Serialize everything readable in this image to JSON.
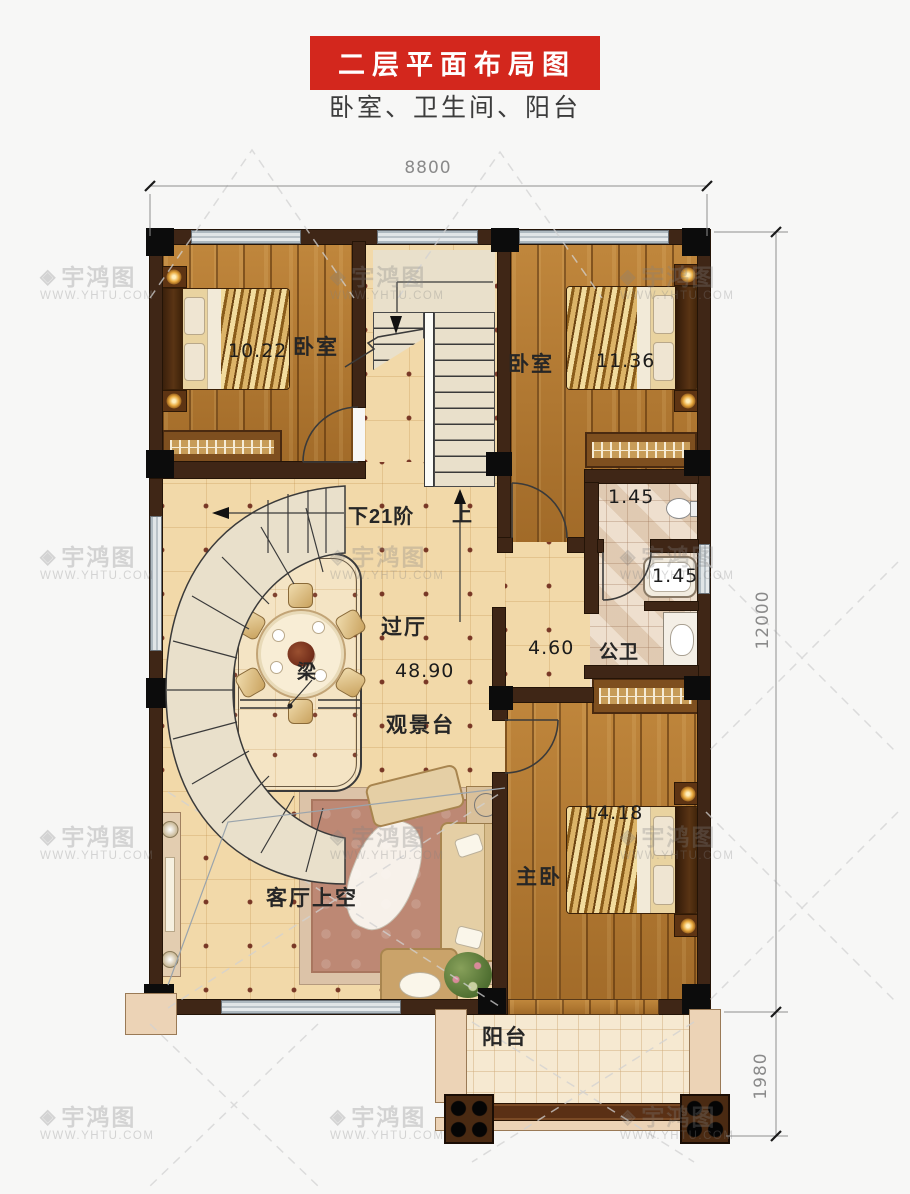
{
  "header": {
    "title": "二层平面布局图",
    "subtitle": "卧室、卫生间、阳台"
  },
  "dimensions": {
    "width_top": "8800",
    "height_right": "12000",
    "balcony_depth": "1980"
  },
  "watermark": {
    "icon": "◈",
    "brand": "宇鸿图",
    "url": "WWW.YHTU.COM"
  },
  "rooms": {
    "bedroom_left": {
      "label": "卧室",
      "area": "10.22"
    },
    "bedroom_right": {
      "label": "卧室",
      "area": "11.36"
    },
    "hall": {
      "label": "过厅",
      "area": "48.90"
    },
    "viewing_deck": {
      "label": "观景台"
    },
    "corridor": {
      "area": "4.60"
    },
    "bath_top": {
      "area": "1.45"
    },
    "bath_mid": {
      "area": "1.45"
    },
    "bathroom": {
      "label": "公卫"
    },
    "master_bedroom": {
      "label": "主卧",
      "area": "14.18"
    },
    "living_void": {
      "label": "客厅上空"
    },
    "balcony": {
      "label": "阳台"
    }
  },
  "stairs": {
    "down": "下21阶",
    "up": "上",
    "beam": "梁"
  }
}
